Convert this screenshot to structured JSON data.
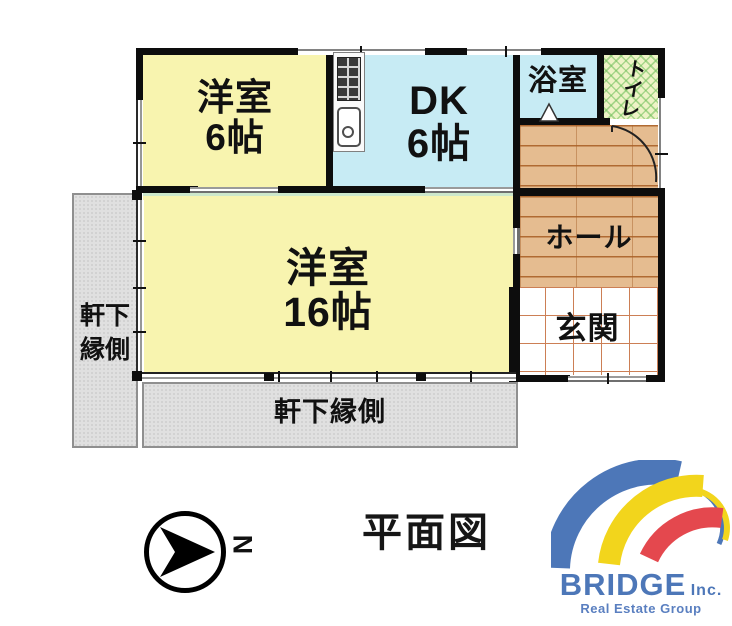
{
  "plan": {
    "title": "平面図",
    "rooms": {
      "western6": {
        "label": "洋室",
        "size": "6帖"
      },
      "dk": {
        "label": "DK",
        "size": "6帖"
      },
      "bathroom": {
        "label": "浴室"
      },
      "toilet": {
        "label": "トイレ"
      },
      "hall": {
        "label": "ホール"
      },
      "entrance": {
        "label": "玄関"
      },
      "western16": {
        "label": "洋室",
        "size": "16帖"
      },
      "engawa_left": {
        "line1": "軒下",
        "line2": "縁側"
      },
      "engawa_bottom": {
        "label": "軒下縁側"
      }
    },
    "compass": {
      "north_label": "N"
    }
  },
  "logo": {
    "name": "BRIDGE",
    "suffix": "Inc.",
    "tagline": "Real Estate Group"
  },
  "colors": {
    "room_yellow": "#f8f4af",
    "room_blue": "#c7ebf4",
    "toilet_green": "#eef3c6",
    "wood_floor": "#e5bc90",
    "tile_line": "#cc7f55",
    "engawa_gray": "#e0e0e0",
    "wall_black": "#0d0d0d",
    "logo_blue": "#4d77b8",
    "logo_yellow": "#f2d51c",
    "logo_red": "#e4484e"
  },
  "icons": {
    "north_arrow": "north-arrow",
    "stove": "gas-stove",
    "sink": "kitchen-sink",
    "door_swing": "door-swing",
    "bath_door": "bath-door"
  }
}
